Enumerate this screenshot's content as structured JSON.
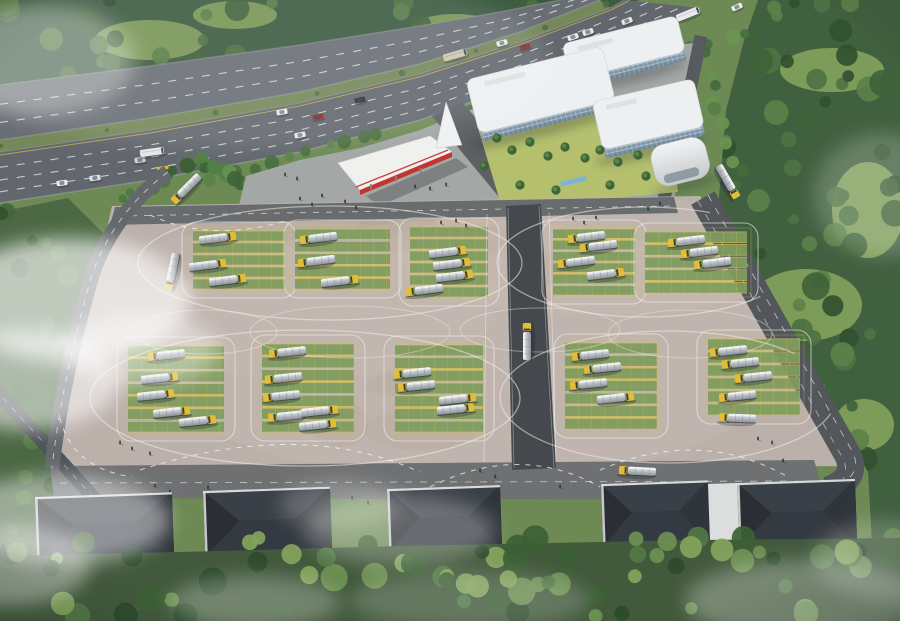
{
  "scene": {
    "w": 900,
    "h": 621,
    "description": "Aerial rendering of a tanker-truck depot campus: highway with traffic at top, white office complex with red-trimmed canopy, large parking ground with green stalls, tanker trucks and white circulation loops, five dark-roofed warehouses along the bottom, surrounded by forest and clouds",
    "base_color": "#6d8a55"
  },
  "palette": {
    "asphalt": "#666c72",
    "paving": "#bcb0aa",
    "stall_green": "#7f9c5e",
    "stall_yellow": "#d4c254",
    "canopy_red": "#c23531",
    "roof_dark": "#272b31",
    "glass": "#7e97ab",
    "truck_cab": "#e3bd35",
    "tank_silver": "#c3c9cf",
    "forest_dark": "#3c5a40",
    "grass_light": "#85a35c",
    "cloud": "#ffffff"
  },
  "clips": {
    "forest_tl": "0,0 640,0 560,25 450,52 300,85 150,118 0,152",
    "forest_r": "758,0 900,0 900,621 858,621 872,545 868,472 718,208 726,110 744,40",
    "lot": "112,206 700,196 862,466 52,470"
  },
  "forests": [
    {
      "name": "forest-top-left",
      "layer": "forest",
      "clip": "forest_tl",
      "base": "#3c5a40",
      "rect": [
        0,
        0,
        640,
        155
      ],
      "count": 90,
      "rmin": 5,
      "rmax": 13,
      "seed": 7,
      "colors": [
        "#2e4a31",
        "#3f6038",
        "#4c6f40",
        "#587c46"
      ],
      "clearings": [
        [
          150,
          40,
          55,
          20
        ],
        [
          310,
          75,
          65,
          24
        ],
        [
          455,
          30,
          45,
          16
        ],
        [
          80,
          120,
          40,
          18
        ],
        [
          235,
          15,
          42,
          14
        ]
      ],
      "clearing_color": "#7d9b57"
    },
    {
      "name": "forest-right",
      "layer": "forest",
      "clip": "forest_r",
      "base": "#41603f",
      "rect": [
        700,
        0,
        200,
        621
      ],
      "count": 100,
      "rmin": 5,
      "rmax": 14,
      "seed": 11,
      "colors": [
        "#31512f",
        "#3f6339",
        "#4e7342",
        "#5c8148"
      ],
      "clearings": [
        [
          832,
          70,
          52,
          22
        ],
        [
          868,
          210,
          36,
          48
        ],
        [
          806,
          305,
          56,
          36
        ],
        [
          864,
          425,
          30,
          26
        ]
      ],
      "clearing_color": "#85a35c"
    },
    {
      "name": "trees-left",
      "layer": "forest",
      "clip": null,
      "base_poly": "0,212 68,198 112,242 120,470 96,560 0,560",
      "base": "#4c6844",
      "rect": [
        0,
        205,
        115,
        350
      ],
      "count": 42,
      "rmin": 5,
      "rmax": 11,
      "seed": 31,
      "colors": [
        "#33522f",
        "#45673c",
        "#567c46"
      ]
    },
    {
      "name": "trees-bottom",
      "layer": "bottom",
      "clip": null,
      "base_poly": "0,556 180,552 400,546 700,540 900,538 900,621 0,621",
      "base": "#42593c",
      "rect": [
        0,
        537,
        900,
        80
      ],
      "count": 75,
      "rmin": 6,
      "rmax": 14,
      "seed": 23,
      "colors": [
        "#2d4a2e",
        "#3d5f36",
        "#527747",
        "#6d9053",
        "#83a45c"
      ]
    }
  ],
  "tree_bands": [
    {
      "name": "highway-roadside",
      "from": [
        205,
        180
      ],
      "to": [
        745,
        32
      ],
      "count": 32,
      "gap": [
        0.34,
        0.47
      ],
      "seed": 41,
      "rmin": 4,
      "rmax": 8,
      "colors": [
        "#4a7040",
        "#5c8449",
        "#6b9452"
      ]
    },
    {
      "name": "campus-east",
      "from": [
        699,
        54
      ],
      "to": [
        740,
        182
      ],
      "count": 12,
      "gap": null,
      "seed": 43,
      "rmin": 4,
      "rmax": 7,
      "colors": [
        "#456b3c",
        "#578047",
        "#69924f"
      ]
    },
    {
      "name": "plaza-west-grove",
      "from": [
        200,
        162
      ],
      "to": [
        268,
        196
      ],
      "count": 14,
      "gap": null,
      "seed": 47,
      "rmin": 5,
      "rmax": 9,
      "colors": [
        "#3f653a",
        "#518046",
        "#63924e"
      ]
    },
    {
      "name": "entrance-grove",
      "from": [
        128,
        196
      ],
      "to": [
        192,
        162
      ],
      "count": 10,
      "gap": null,
      "seed": 53,
      "rmin": 4,
      "rmax": 8,
      "colors": [
        "#3a5f36",
        "#4d7842"
      ]
    }
  ],
  "highway": {
    "bandA_up": [
      [
        0,
        85
      ],
      [
        150,
        66
      ],
      [
        300,
        45
      ],
      [
        420,
        26
      ],
      [
        500,
        12
      ],
      [
        560,
        0
      ]
    ],
    "bandA_low": [
      [
        0,
        140
      ],
      [
        150,
        118
      ],
      [
        300,
        92
      ],
      [
        420,
        64
      ],
      [
        520,
        32
      ],
      [
        600,
        0
      ]
    ],
    "bandB_up": [
      [
        0,
        152
      ],
      [
        150,
        130
      ],
      [
        300,
        103
      ],
      [
        420,
        74
      ],
      [
        520,
        42
      ],
      [
        610,
        8
      ],
      [
        625,
        0
      ]
    ],
    "bandB_low": [
      [
        0,
        203
      ],
      [
        150,
        180
      ],
      [
        300,
        152
      ],
      [
        420,
        120
      ],
      [
        540,
        78
      ],
      [
        640,
        34
      ],
      [
        700,
        8
      ]
    ],
    "colorA": "#686e74",
    "colorB": "#61676d",
    "median_color": "#75885a",
    "lanesA": [
      0.35,
      0.68
    ],
    "lanesB": [
      0.3,
      0.55,
      0.78
    ],
    "vehicles": [
      [
        62,
        183,
        -8,
        "car",
        "#e9ebee"
      ],
      [
        95,
        178,
        -8,
        "car",
        "#dde0e4"
      ],
      [
        140,
        160,
        -8,
        "car",
        "#cfd3d7"
      ],
      [
        152,
        152,
        -8,
        "bus",
        "#e5e7e8"
      ],
      [
        163,
        169,
        -8,
        "car",
        "#d9bc3e"
      ],
      [
        190,
        163,
        -8,
        "car",
        "#eef0f2"
      ],
      [
        282,
        112,
        -11,
        "car",
        "#e8eaed"
      ],
      [
        300,
        135,
        -11,
        "car",
        "#e6e8ea"
      ],
      [
        318,
        117,
        -11,
        "car",
        "#8e2f2c"
      ],
      [
        360,
        100,
        -12,
        "car",
        "#2f3438"
      ],
      [
        455,
        55,
        -16,
        "bus",
        "#cfc6b4"
      ],
      [
        502,
        43,
        -16,
        "car",
        "#eef0f1"
      ],
      [
        525,
        47,
        -16,
        "car",
        "#922f2b"
      ],
      [
        573,
        37,
        -18,
        "car",
        "#ecedef"
      ],
      [
        588,
        32,
        -18,
        "car",
        "#e8eaec"
      ],
      [
        627,
        21,
        -20,
        "car",
        "#e4e6e9"
      ],
      [
        688,
        14,
        -22,
        "bus",
        "#e9eaeb"
      ],
      [
        737,
        7,
        -24,
        "car",
        "#eceef0"
      ]
    ]
  },
  "campus": {
    "plaza_poly": "236,218 246,176 300,160 360,148 420,130 470,110 540,88 600,62 640,50 700,42 688,140 672,208 520,216",
    "plaza_color": "#a3a7a5",
    "entrance_poly": "432,116 462,102 545,198 508,208",
    "entrance_color": "#5d6165",
    "side_road": "M701,36 C690,92 679,142 664,198",
    "side_road_color": "#565b60",
    "courtyard_poly": "478,128 662,100 678,192 502,208",
    "courtyard_color": "#b5c06e",
    "courtyard_trees": [
      [
        497,
        138
      ],
      [
        512,
        150
      ],
      [
        530,
        142
      ],
      [
        548,
        156
      ],
      [
        565,
        147
      ],
      [
        585,
        158
      ],
      [
        600,
        150
      ],
      [
        618,
        162
      ],
      [
        638,
        155
      ],
      [
        520,
        185
      ],
      [
        556,
        190
      ],
      [
        610,
        185
      ],
      [
        646,
        176
      ],
      [
        484,
        166
      ]
    ],
    "pool": [
      560,
      182,
      26,
      5
    ],
    "pool_color": "#7db4d6",
    "blocks": [
      {
        "x": 562,
        "y": 44,
        "w": 118,
        "h": 46,
        "rot": -14
      },
      {
        "x": 466,
        "y": 80,
        "w": 140,
        "h": 64,
        "rot": -14
      },
      {
        "x": 592,
        "y": 102,
        "w": 104,
        "h": 58,
        "rot": -13
      }
    ],
    "roof": "#edeff1",
    "roof_edge": "#d3d8db",
    "pavilion": {
      "x": 648,
      "y": 148,
      "w": 56,
      "h": 42,
      "rot": -14
    },
    "canopy": {
      "poly": "338,163 430,136 452,152 360,190",
      "fascia_poly": "360,190 452,152 452,157 360,195",
      "red_line": [
        356,
        187,
        448,
        150
      ],
      "roof": "#f0f0ee",
      "red": "#c23531",
      "shadow_poly": "366,196 456,158 468,167 380,206"
    },
    "sail_poly": "436,148 446,102 462,145"
  },
  "lot": {
    "poly": "112,206 700,196 862,466 52,470",
    "fill": "#bcb0aa",
    "lights": [
      [
        470,
        350,
        330,
        130,
        0.16
      ],
      [
        600,
        255,
        200,
        60,
        0.14
      ],
      [
        300,
        300,
        200,
        80,
        0.1
      ]
    ],
    "light_color": "#d9d0c7",
    "mottle_color": "#8d7f78",
    "mottles_seed": 55,
    "top_road": {
      "poly": "115,207 674,197 678,213 110,225",
      "color": "#696c6f"
    },
    "bottom_road": {
      "poly": "50,466 814,460 826,500 54,498",
      "color": "#6e7072"
    },
    "center_road": {
      "poly": "506,206 541,204 556,468 512,470",
      "color": "#45494d"
    },
    "left_road": {
      "path": "M168,172 C130,200 102,240 90,282 C72,345 58,412 52,468",
      "color": "#64686d",
      "width": 15
    },
    "outer_road": {
      "path": "M-6,388 L125,532",
      "color": "#4e5357",
      "width": 14
    },
    "right_road": {
      "path": "M703,198 C758,295 806,382 846,452 C856,469 850,482 828,490",
      "color": "#53575b",
      "width": 27
    },
    "blocks": [
      {
        "x": 193,
        "y": 230,
        "w": 92,
        "h": 60,
        "rows": 5
      },
      {
        "x": 295,
        "y": 228,
        "w": 95,
        "h": 62,
        "rows": 5
      },
      {
        "x": 410,
        "y": 226,
        "w": 78,
        "h": 72,
        "rows": 6
      },
      {
        "x": 553,
        "y": 228,
        "w": 82,
        "h": 68,
        "rows": 6
      },
      {
        "x": 645,
        "y": 231,
        "w": 102,
        "h": 63,
        "rows": 5
      },
      {
        "x": 128,
        "y": 345,
        "w": 96,
        "h": 88,
        "rows": 7
      },
      {
        "x": 262,
        "y": 343,
        "w": 92,
        "h": 90,
        "rows": 7
      },
      {
        "x": 395,
        "y": 344,
        "w": 88,
        "h": 89,
        "rows": 7
      },
      {
        "x": 565,
        "y": 342,
        "w": 92,
        "h": 88,
        "rows": 7
      },
      {
        "x": 708,
        "y": 338,
        "w": 92,
        "h": 78,
        "rows": 6
      }
    ],
    "stall_green": "#7f9c5e",
    "stall_line": "#d4c254",
    "outline": "#f2efe7",
    "loops": [
      [
        330,
        263,
        192,
        57
      ],
      [
        645,
        262,
        148,
        55
      ],
      [
        305,
        398,
        215,
        68
      ],
      [
        668,
        397,
        168,
        66
      ]
    ],
    "mid_loops": [
      [
        350,
        332,
        100,
        26
      ],
      [
        540,
        330,
        80,
        22
      ],
      [
        205,
        332,
        72,
        22
      ],
      [
        690,
        334,
        82,
        24
      ]
    ],
    "aisle_lines": [
      [
        487,
        214,
        484,
        462
      ],
      [
        549,
        212,
        556,
        462
      ]
    ],
    "dashed_arcs": [
      "M140,470 Q300,418 420,472",
      "M430,487 Q520,442 600,487",
      "M600,470 Q700,427 788,477",
      "M150,215 Q210,243 285,221",
      "M60,418 Q72,468 132,477"
    ],
    "trucks": [
      [
        218,
        238,
        -7,
        0
      ],
      [
        208,
        265,
        -7,
        0
      ],
      [
        228,
        280,
        -7,
        0
      ],
      [
        318,
        238,
        -7,
        1
      ],
      [
        316,
        261,
        -7,
        1
      ],
      [
        340,
        281,
        -7,
        0
      ],
      [
        448,
        252,
        -7,
        0
      ],
      [
        452,
        264,
        -7,
        0
      ],
      [
        455,
        276,
        -7,
        0
      ],
      [
        424,
        290,
        -7,
        1
      ],
      [
        586,
        237,
        -7,
        1
      ],
      [
        598,
        246,
        -7,
        1
      ],
      [
        576,
        262,
        -7,
        1
      ],
      [
        606,
        274,
        -7,
        0
      ],
      [
        686,
        241,
        -7,
        1
      ],
      [
        699,
        252,
        -7,
        1
      ],
      [
        712,
        263,
        -7,
        1
      ],
      [
        166,
        355,
        -6,
        1
      ],
      [
        160,
        378,
        -6,
        0
      ],
      [
        156,
        395,
        -6,
        0
      ],
      [
        172,
        412,
        -6,
        0
      ],
      [
        198,
        421,
        -6,
        0
      ],
      [
        287,
        352,
        -6,
        1
      ],
      [
        283,
        378,
        -6,
        1
      ],
      [
        281,
        396,
        -6,
        1
      ],
      [
        286,
        416,
        -6,
        1
      ],
      [
        320,
        411,
        -6,
        0
      ],
      [
        318,
        425,
        -6,
        0
      ],
      [
        412,
        373,
        -6,
        1
      ],
      [
        416,
        386,
        -6,
        1
      ],
      [
        458,
        399,
        -6,
        0
      ],
      [
        456,
        409,
        -6,
        0
      ],
      [
        590,
        355,
        -6,
        1
      ],
      [
        602,
        368,
        -6,
        1
      ],
      [
        588,
        384,
        -6,
        1
      ],
      [
        616,
        398,
        -6,
        0
      ],
      [
        728,
        351,
        -6,
        1
      ],
      [
        740,
        363,
        -6,
        1
      ],
      [
        753,
        377,
        -6,
        1
      ],
      [
        737,
        396,
        -6,
        1
      ],
      [
        186,
        189,
        -45,
        1
      ],
      [
        172,
        272,
        -78,
        1
      ],
      [
        728,
        182,
        60,
        0
      ],
      [
        527,
        341,
        -90,
        0
      ],
      [
        737,
        418,
        2,
        1
      ],
      [
        637,
        471,
        3,
        1
      ]
    ]
  },
  "warehouses": {
    "items": [
      [
        35,
        497,
        137,
        76
      ],
      [
        203,
        491,
        127,
        79
      ],
      [
        387,
        489,
        113,
        76
      ],
      [
        601,
        484,
        107,
        76
      ],
      [
        737,
        483,
        118,
        79
      ]
    ],
    "rot": -2,
    "roof_dark": "#272b31",
    "faces": [
      "#3a4047",
      "#343a42",
      "#2b2f35",
      "#30353b"
    ],
    "parapet": "#d7d9d7",
    "wall": "#bcbfbc",
    "window": "#4b5054",
    "walkway": [
      708,
      484,
      29,
      58
    ],
    "walkway_color": "#dcdedd"
  },
  "people": [
    [
      300,
      200
    ],
    [
      312,
      206
    ],
    [
      322,
      197
    ],
    [
      345,
      203
    ],
    [
      356,
      209
    ],
    [
      285,
      176
    ],
    [
      297,
      180
    ],
    [
      415,
      188
    ],
    [
      430,
      190
    ],
    [
      446,
      186
    ],
    [
      441,
      224
    ],
    [
      456,
      222
    ],
    [
      466,
      227
    ],
    [
      573,
      220
    ],
    [
      584,
      224
    ],
    [
      596,
      219
    ],
    [
      648,
      210
    ],
    [
      660,
      205
    ],
    [
      120,
      444
    ],
    [
      132,
      450
    ],
    [
      150,
      455
    ],
    [
      155,
      487
    ],
    [
      170,
      493
    ],
    [
      208,
      489
    ],
    [
      352,
      499
    ],
    [
      368,
      504
    ],
    [
      480,
      472
    ],
    [
      495,
      478
    ],
    [
      560,
      488
    ],
    [
      610,
      489
    ],
    [
      642,
      492
    ],
    [
      700,
      499
    ],
    [
      758,
      440
    ],
    [
      772,
      444
    ],
    [
      783,
      462
    ]
  ],
  "clouds": [
    [
      250,
      60,
      300,
      90,
      0.1
    ],
    [
      40,
      60,
      95,
      55,
      0.32
    ],
    [
      70,
      300,
      120,
      62,
      0.65
    ],
    [
      25,
      380,
      95,
      50,
      0.55
    ],
    [
      140,
      350,
      80,
      35,
      0.4
    ],
    [
      60,
      520,
      110,
      45,
      0.45
    ],
    [
      10,
      565,
      80,
      40,
      0.4
    ],
    [
      400,
      530,
      95,
      35,
      0.26
    ],
    [
      340,
      505,
      60,
      25,
      0.22
    ],
    [
      884,
      195,
      70,
      62,
      0.2
    ],
    [
      805,
      600,
      120,
      40,
      0.28
    ],
    [
      893,
      560,
      80,
      40,
      0.22
    ],
    [
      255,
      602,
      85,
      26,
      0.26
    ],
    [
      470,
      600,
      120,
      30,
      0.18
    ]
  ]
}
